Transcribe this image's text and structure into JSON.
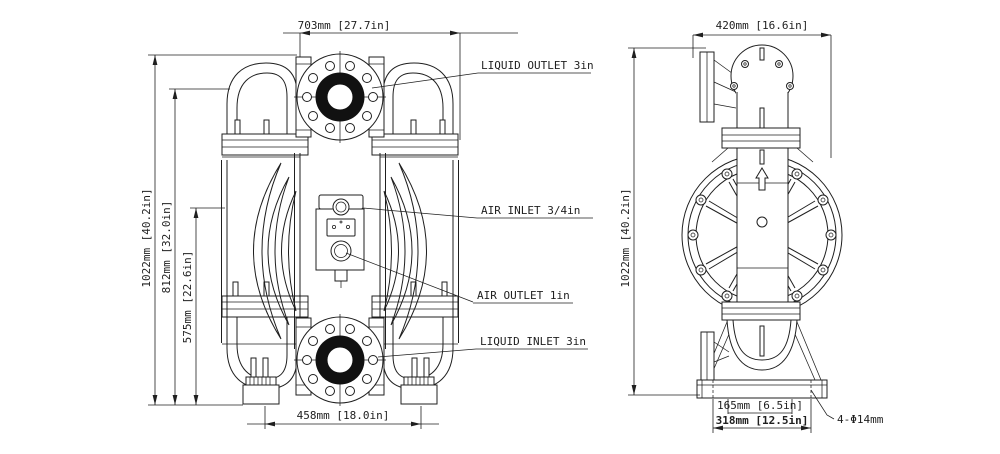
{
  "front_view": {
    "dim_width_top": "703mm [27.7in]",
    "dim_height_overall": "1022mm [40.2in]",
    "dim_height_mid": "812mm [32.0in]",
    "dim_height_lower": "575mm [22.6in]",
    "dim_width_bottom": "458mm [18.0in]",
    "port_labels": {
      "liquid_outlet": "LIQUID OUTLET 3in",
      "air_inlet": "AIR INLET 3/4in",
      "air_outlet": "AIR OUTLET 1in",
      "liquid_inlet": "LIQUID INLET 3in"
    }
  },
  "side_view": {
    "dim_width_top": "420mm [16.6in]",
    "dim_height_overall": "1022mm [40.2in]",
    "dim_base_inner": "165mm [6.5in]",
    "dim_base_outer": "318mm [12.5in]",
    "dim_mounting_holes": "4-Φ14mm"
  },
  "colors": {
    "line": "#1f1f1f",
    "port_ring_fill": "#111111",
    "background": "#ffffff"
  }
}
